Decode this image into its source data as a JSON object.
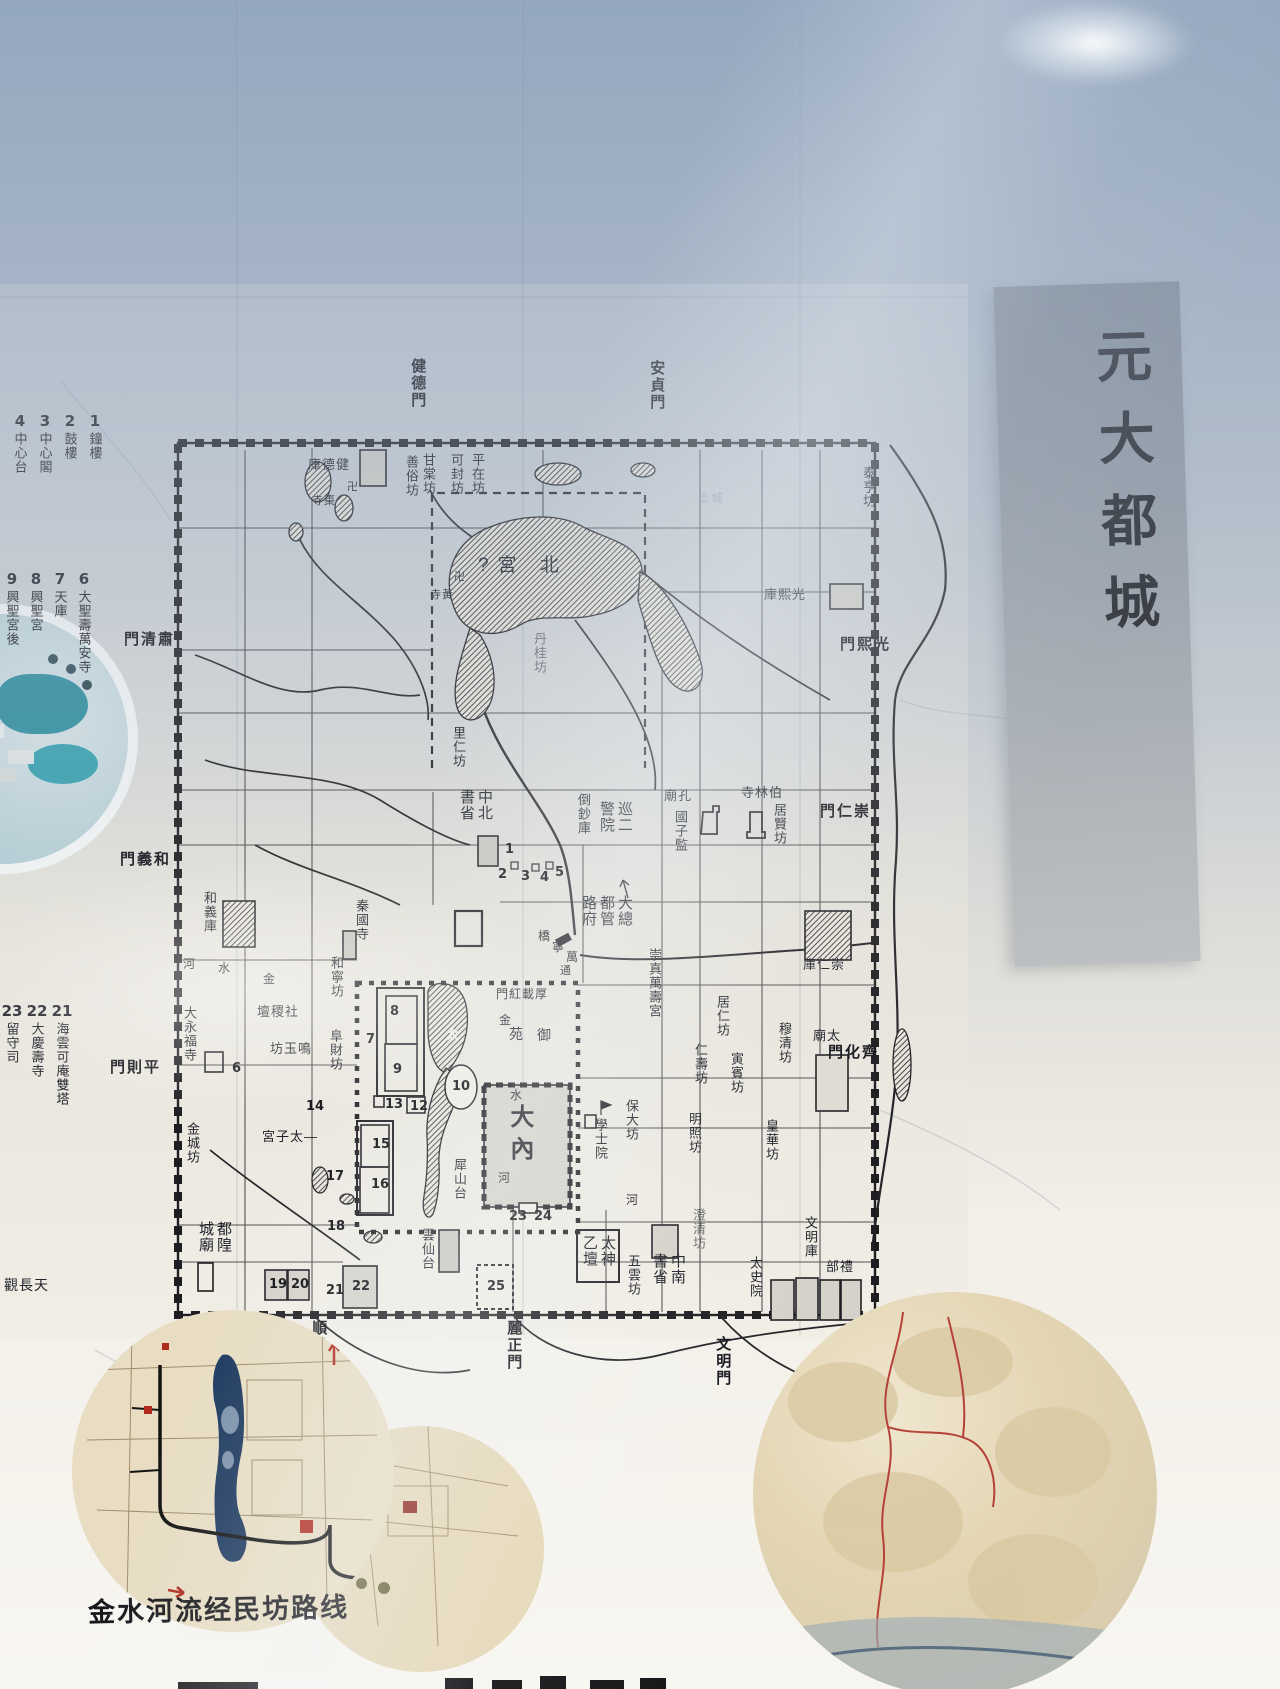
{
  "banner": {
    "text": "元大都城"
  },
  "map": {
    "vlabels": [
      {
        "t": "健德門",
        "x": 409,
        "y": 358,
        "cls": "gate",
        "name": "gate-jiandemen"
      },
      {
        "t": "安貞門",
        "x": 648,
        "y": 360,
        "cls": "gate",
        "name": "gate-anzhenmen"
      },
      {
        "t": "善俗坊",
        "x": 404,
        "y": 455,
        "name": "fang-shansu"
      },
      {
        "t": "甘棠坊",
        "x": 421,
        "y": 453,
        "name": "fang-gantang"
      },
      {
        "t": "可封坊",
        "x": 449,
        "y": 453,
        "name": "fang-kefeng"
      },
      {
        "t": "平在坊",
        "x": 470,
        "y": 453,
        "name": "fang-pingzai"
      },
      {
        "t": "泰亨坊",
        "x": 861,
        "y": 466,
        "name": "fang-taiheng"
      },
      {
        "t": "丹桂坊",
        "x": 532,
        "y": 632,
        "cls": "faint",
        "name": "fang-dangui"
      },
      {
        "t": "里仁坊",
        "x": 451,
        "y": 726,
        "name": "fang-liren"
      },
      {
        "t": "倒鈔庫",
        "x": 576,
        "y": 793,
        "name": "site-daochaoku"
      },
      {
        "t": "國子監",
        "x": 673,
        "y": 810,
        "name": "site-guozijian"
      },
      {
        "t": "居賢坊",
        "x": 772,
        "y": 803,
        "name": "fang-juxian"
      },
      {
        "t": "崇真萬壽宮",
        "x": 647,
        "y": 948,
        "name": "site-chongzhenwanshougong"
      },
      {
        "t": "穆清坊",
        "x": 777,
        "y": 1022,
        "name": "fang-muqing"
      },
      {
        "t": "居仁坊",
        "x": 715,
        "y": 995,
        "name": "fang-juren"
      },
      {
        "t": "寅賓坊",
        "x": 729,
        "y": 1052,
        "name": "fang-yinbin"
      },
      {
        "t": "仁壽坊",
        "x": 693,
        "y": 1043,
        "name": "fang-renshou"
      },
      {
        "t": "保大坊",
        "x": 624,
        "y": 1099,
        "name": "fang-baoda"
      },
      {
        "t": "明照坊",
        "x": 687,
        "y": 1112,
        "name": "fang-mingzhao"
      },
      {
        "t": "皇華坊",
        "x": 764,
        "y": 1119,
        "name": "fang-huanghua"
      },
      {
        "t": "澄清坊",
        "x": 691,
        "y": 1208,
        "cls": "faint",
        "name": "fang-chengqing"
      },
      {
        "t": "學士院",
        "x": 593,
        "y": 1118,
        "name": "site-xueshiyuan"
      },
      {
        "t": "太史院",
        "x": 748,
        "y": 1256,
        "name": "site-taishiyuan"
      },
      {
        "t": "文明庫",
        "x": 803,
        "y": 1216,
        "name": "site-wenmingku"
      },
      {
        "t": "五雲坊",
        "x": 626,
        "y": 1254,
        "name": "fang-wuyun"
      },
      {
        "t": "雲仙台",
        "x": 420,
        "y": 1228,
        "name": "site-yunxiantai"
      },
      {
        "t": "犀山台",
        "x": 452,
        "y": 1158,
        "name": "site-xishantai"
      },
      {
        "t": "大永福寺",
        "x": 182,
        "y": 1006,
        "name": "site-dayongfusi"
      },
      {
        "t": "金城坊",
        "x": 185,
        "y": 1122,
        "name": "fang-jincheng"
      },
      {
        "t": "和義庫",
        "x": 202,
        "y": 891,
        "name": "site-heyiku"
      },
      {
        "t": "和寧坊",
        "x": 329,
        "y": 956,
        "name": "fang-hening"
      },
      {
        "t": "阜財坊",
        "x": 328,
        "y": 1029,
        "name": "fang-fucai"
      },
      {
        "t": "秦國寺",
        "x": 354,
        "y": 899,
        "name": "site-qinguosi"
      },
      {
        "t": "大內",
        "x": 506,
        "y": 1104,
        "cls": "big",
        "s": 24,
        "name": "site-danei"
      },
      {
        "t": "順承門",
        "x": 310,
        "y": 1320,
        "cls": "gate",
        "name": "gate-shunchengmen"
      },
      {
        "t": "麗正門",
        "x": 505,
        "y": 1320,
        "cls": "gate",
        "name": "gate-lizhengmen"
      },
      {
        "t": "文明門",
        "x": 714,
        "y": 1336,
        "cls": "gate",
        "name": "gate-wenmingmen"
      }
    ],
    "hlabels": [
      {
        "t": "庫德健",
        "x": 308,
        "y": 458,
        "name": "site-jiandeku"
      },
      {
        "t": "寺棗",
        "x": 312,
        "y": 496,
        "s": 11,
        "name": "site-zaosi"
      },
      {
        "t": "卍",
        "x": 347,
        "y": 482,
        "s": 11,
        "name": "swastika-temple-mark"
      },
      {
        "t": "寺黃",
        "x": 430,
        "y": 590,
        "s": 11,
        "name": "site-huangsi"
      },
      {
        "t": "卍",
        "x": 454,
        "y": 572,
        "s": 11,
        "name": "swastika-temple-mark"
      },
      {
        "t": "?宮 北",
        "x": 478,
        "y": 556,
        "s": 19,
        "sp": 9,
        "name": "site-beigong"
      },
      {
        "t": "庫熙光",
        "x": 764,
        "y": 588,
        "name": "site-guangxiku"
      },
      {
        "t": "門清肅",
        "x": 124,
        "y": 632,
        "cls": "gate",
        "name": "gate-suqingmen"
      },
      {
        "t": "門義和",
        "x": 120,
        "y": 852,
        "cls": "gate",
        "name": "gate-heyimen"
      },
      {
        "t": "門則平",
        "x": 110,
        "y": 1060,
        "cls": "gate",
        "name": "gate-pingzemen"
      },
      {
        "t": "門熙光",
        "x": 840,
        "y": 637,
        "cls": "gate",
        "name": "gate-guangximen"
      },
      {
        "t": "門仁崇",
        "x": 820,
        "y": 804,
        "cls": "gate",
        "name": "gate-chongrenmen"
      },
      {
        "t": "門化齊",
        "x": 828,
        "y": 1045,
        "cls": "gate",
        "name": "gate-qihuamen"
      },
      {
        "t": "庫仁崇",
        "x": 803,
        "y": 958,
        "name": "site-chongrenku"
      },
      {
        "t": "廟孔",
        "x": 664,
        "y": 789,
        "name": "site-kongmiao"
      },
      {
        "t": "寺林伯",
        "x": 741,
        "y": 786,
        "name": "site-bolinsi"
      },
      {
        "t": "廟太",
        "x": 813,
        "y": 1029,
        "name": "site-taimiao"
      },
      {
        "t": "部禮",
        "x": 826,
        "y": 1260,
        "name": "site-libu"
      },
      {
        "t": "壇稷社",
        "x": 257,
        "y": 1005,
        "name": "site-shejitan"
      },
      {
        "t": "坊玉鳴",
        "x": 270,
        "y": 1042,
        "name": "fang-mingyu"
      },
      {
        "t": "宮子太—",
        "x": 262,
        "y": 1130,
        "name": "site-taizigong"
      },
      {
        "t": "觀長天",
        "x": 4,
        "y": 1278,
        "s": 14,
        "name": "site-tianchangguan"
      },
      {
        "t": "門紅載厚",
        "x": 496,
        "y": 988,
        "s": 12,
        "name": "gate-houzaihongmen"
      },
      {
        "t": "橋",
        "x": 538,
        "y": 930,
        "s": 12,
        "name": "site-wanningqiao"
      },
      {
        "t": "寧",
        "x": 552,
        "y": 941,
        "s": 12,
        "name": "site-wanningqiao"
      },
      {
        "t": "萬",
        "x": 566,
        "y": 951,
        "s": 12,
        "name": "site-wanningqiao"
      },
      {
        "t": "河",
        "x": 183,
        "y": 958,
        "s": 12,
        "name": "river-jinshuihe"
      },
      {
        "t": "水",
        "x": 218,
        "y": 962,
        "s": 12,
        "name": "river-jinshuihe"
      },
      {
        "t": "金",
        "x": 263,
        "y": 973,
        "s": 12,
        "name": "river-jinshuihe"
      },
      {
        "t": "金",
        "x": 499,
        "y": 1014,
        "s": 12,
        "name": "river-jinshuihe"
      },
      {
        "t": "水",
        "x": 510,
        "y": 1089,
        "s": 12,
        "name": "river-jinshuihe"
      },
      {
        "t": "河",
        "x": 498,
        "y": 1172,
        "s": 12,
        "name": "river-jinshuihe"
      },
      {
        "t": "通",
        "x": 560,
        "y": 966,
        "s": 11,
        "name": "river-tonghuihe"
      },
      {
        "t": "河",
        "x": 626,
        "y": 1194,
        "s": 12,
        "name": "river-char"
      },
      {
        "t": "苑",
        "x": 509,
        "y": 1027,
        "s": 14,
        "name": "site-yuyuan"
      },
      {
        "t": "御",
        "x": 537,
        "y": 1028,
        "s": 14,
        "name": "site-yuyuan"
      },
      {
        "t": "太",
        "x": 446,
        "y": 1028,
        "s": 13,
        "cls": "white",
        "name": "lake-taiyechi"
      },
      {
        "t": "土城",
        "x": 698,
        "y": 492,
        "s": 12,
        "cls": "ghost",
        "name": "ghost-tucheng"
      }
    ],
    "grids": [
      {
        "rows": [
          "書中",
          "省北"
        ],
        "x": 460,
        "y": 790,
        "name": "site-zhongshubeisheng"
      },
      {
        "rows": [
          "警巡",
          "院二"
        ],
        "x": 600,
        "y": 802,
        "name": "site-jingxuneryuan"
      },
      {
        "rows": [
          "路都大",
          "府管總"
        ],
        "x": 582,
        "y": 896,
        "name": "site-dadulu-zongguanfu"
      },
      {
        "rows": [
          "書中",
          "省南"
        ],
        "x": 653,
        "y": 1254,
        "name": "site-zhongshunansheng"
      },
      {
        "rows": [
          "乙太",
          "壇神"
        ],
        "x": 583,
        "y": 1236,
        "name": "site-taiyishentan"
      },
      {
        "rows": [
          "城都",
          "廟隍"
        ],
        "x": 199,
        "y": 1222,
        "name": "site-ducheng-huangmiao"
      }
    ],
    "numbers": [
      {
        "n": "1",
        "x": 505,
        "y": 843
      },
      {
        "n": "2",
        "x": 498,
        "y": 868
      },
      {
        "n": "3",
        "x": 521,
        "y": 870
      },
      {
        "n": "4",
        "x": 540,
        "y": 871
      },
      {
        "n": "5",
        "x": 555,
        "y": 866
      },
      {
        "n": "6",
        "x": 232,
        "y": 1062
      },
      {
        "n": "7",
        "x": 366,
        "y": 1033
      },
      {
        "n": "8",
        "x": 390,
        "y": 1005
      },
      {
        "n": "9",
        "x": 393,
        "y": 1063
      },
      {
        "n": "10",
        "x": 452,
        "y": 1080
      },
      {
        "n": "12",
        "x": 410,
        "y": 1100
      },
      {
        "n": "13",
        "x": 385,
        "y": 1098
      },
      {
        "n": "14",
        "x": 306,
        "y": 1100
      },
      {
        "n": "15",
        "x": 372,
        "y": 1138
      },
      {
        "n": "16",
        "x": 371,
        "y": 1178
      },
      {
        "n": "17",
        "x": 326,
        "y": 1170
      },
      {
        "n": "18",
        "x": 327,
        "y": 1220
      },
      {
        "n": "19",
        "x": 269,
        "y": 1278
      },
      {
        "n": "20",
        "x": 291,
        "y": 1278
      },
      {
        "n": "21",
        "x": 326,
        "y": 1284
      },
      {
        "n": "22",
        "x": 352,
        "y": 1280
      },
      {
        "n": "23",
        "x": 509,
        "y": 1210
      },
      {
        "n": "24",
        "x": 534,
        "y": 1210
      },
      {
        "n": "25",
        "x": 487,
        "y": 1280
      }
    ]
  },
  "legend": {
    "groups": [
      {
        "x": 8,
        "y": 412,
        "colw": 25,
        "items": [
          {
            "n": "1",
            "t": "鐘樓"
          },
          {
            "n": "2",
            "t": "鼓樓"
          },
          {
            "n": "3",
            "t": "中心閣"
          },
          {
            "n": "4",
            "t": "中心台"
          }
        ]
      },
      {
        "x": 0,
        "y": 570,
        "colw": 24,
        "items": [
          {
            "n": "6",
            "t": "大聖壽萬安寺"
          },
          {
            "n": "7",
            "t": "天庫"
          },
          {
            "n": "8",
            "t": "興聖宮"
          },
          {
            "n": "9",
            "t": "興聖宮後"
          }
        ]
      },
      {
        "x": 0,
        "y": 1002,
        "colw": 25,
        "items": [
          {
            "n": "21",
            "t": "海雲可庵雙塔"
          },
          {
            "n": "22",
            "t": "大慶壽寺"
          },
          {
            "n": "23",
            "t": "留守司"
          }
        ]
      }
    ]
  },
  "insets": {
    "left_caption": "金水河流经民坊路线"
  }
}
